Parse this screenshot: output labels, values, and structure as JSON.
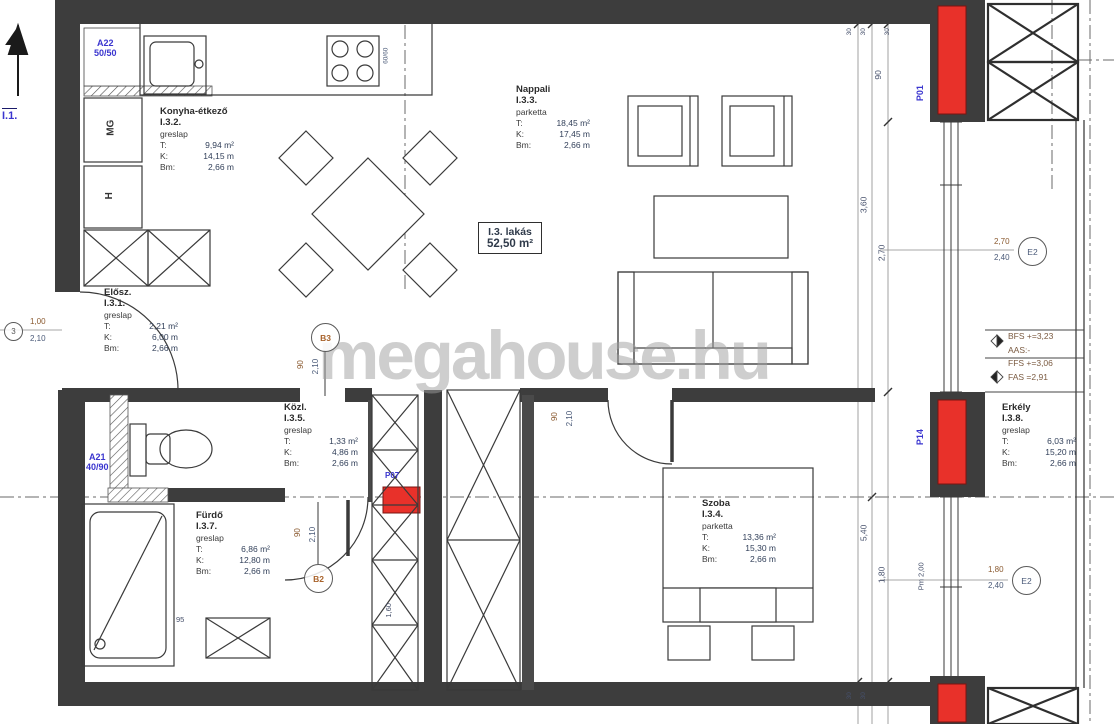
{
  "watermark": "megahouse.hu",
  "apartment": {
    "id": "I.3. lakás",
    "area": "52,50 m²"
  },
  "labels": {
    "t": "T:",
    "k": "K:",
    "bm": "Bm:"
  },
  "rooms": {
    "eloszoba": {
      "name": "Elősz.",
      "number": "I.3.1.",
      "floor": "greslap",
      "t": "2,21 m²",
      "k": "6,00 m",
      "bm": "2,66 m"
    },
    "konyha": {
      "name": "Konyha-étkező",
      "number": "I.3.2.",
      "floor": "greslap",
      "t": "9,94 m²",
      "k": "14,15 m",
      "bm": "2,66 m"
    },
    "nappali": {
      "name": "Nappali",
      "number": "I.3.3.",
      "floor": "parketta",
      "t": "18,45 m²",
      "k": "17,45 m",
      "bm": "2,66 m"
    },
    "szoba": {
      "name": "Szoba",
      "number": "I.3.4.",
      "floor": "parketta",
      "t": "13,36 m²",
      "k": "15,30 m",
      "bm": "2,66 m"
    },
    "kozlekedo": {
      "name": "Közl.",
      "number": "I.3.5.",
      "floor": "greslap",
      "t": "1,33 m²",
      "k": "4,86 m",
      "bm": "2,66 m"
    },
    "furdo": {
      "name": "Fürdő",
      "number": "I.3.7.",
      "floor": "greslap",
      "t": "6,86 m²",
      "k": "12,80 m",
      "bm": "2,66 m"
    },
    "erkely": {
      "name": "Erkély",
      "number": "I.3.8.",
      "floor": "greslap",
      "t": "6,03 m²",
      "k": "15,20 m",
      "bm": "2,66 m"
    }
  },
  "tags": {
    "a22": "A22",
    "a22_size": "50/50",
    "a21": "A21",
    "a21_size": "40/90",
    "p01": "P01",
    "p14": "P14",
    "p07": "P07",
    "i1": "I.1.",
    "mg": "MG",
    "h": "H"
  },
  "markers": {
    "entry": "3",
    "b3": "B3",
    "b2": "B2",
    "window": "E2",
    "balcony_door": "E2"
  },
  "dims": {
    "entry_w": "1,00",
    "entry_h": "2,10",
    "b3_w": "90",
    "b3_h": "2,10",
    "b2_w": "90",
    "b2_h": "2,10",
    "szoba_w": "90",
    "szoba_h": "2,10",
    "win_w": "2,70",
    "win_h": "2,40",
    "bal_w": "1,80",
    "bal_h": "2,40",
    "chain_90_top": "90",
    "chain_360": "3,60",
    "chain_270": "2,70",
    "chain_540": "5,40",
    "chain_180": "1,80",
    "parapet": "Pm 2,00",
    "tick1": "30",
    "tick2": "30",
    "tick3": "30",
    "tickb1": "30",
    "tickb2": "30",
    "stove": "60/60",
    "shower": "95",
    "shaft": "1,60"
  },
  "levels": {
    "bfs": "BFS +=3,23",
    "aas": "AAS:-",
    "ffs": "FFS +=3,06",
    "fas": "FAS =2,91"
  },
  "colors": {
    "red": "#e8312a",
    "blue": "#3a35cf",
    "wall": "#3d3d3d",
    "watermark": "#9e9e9e"
  }
}
